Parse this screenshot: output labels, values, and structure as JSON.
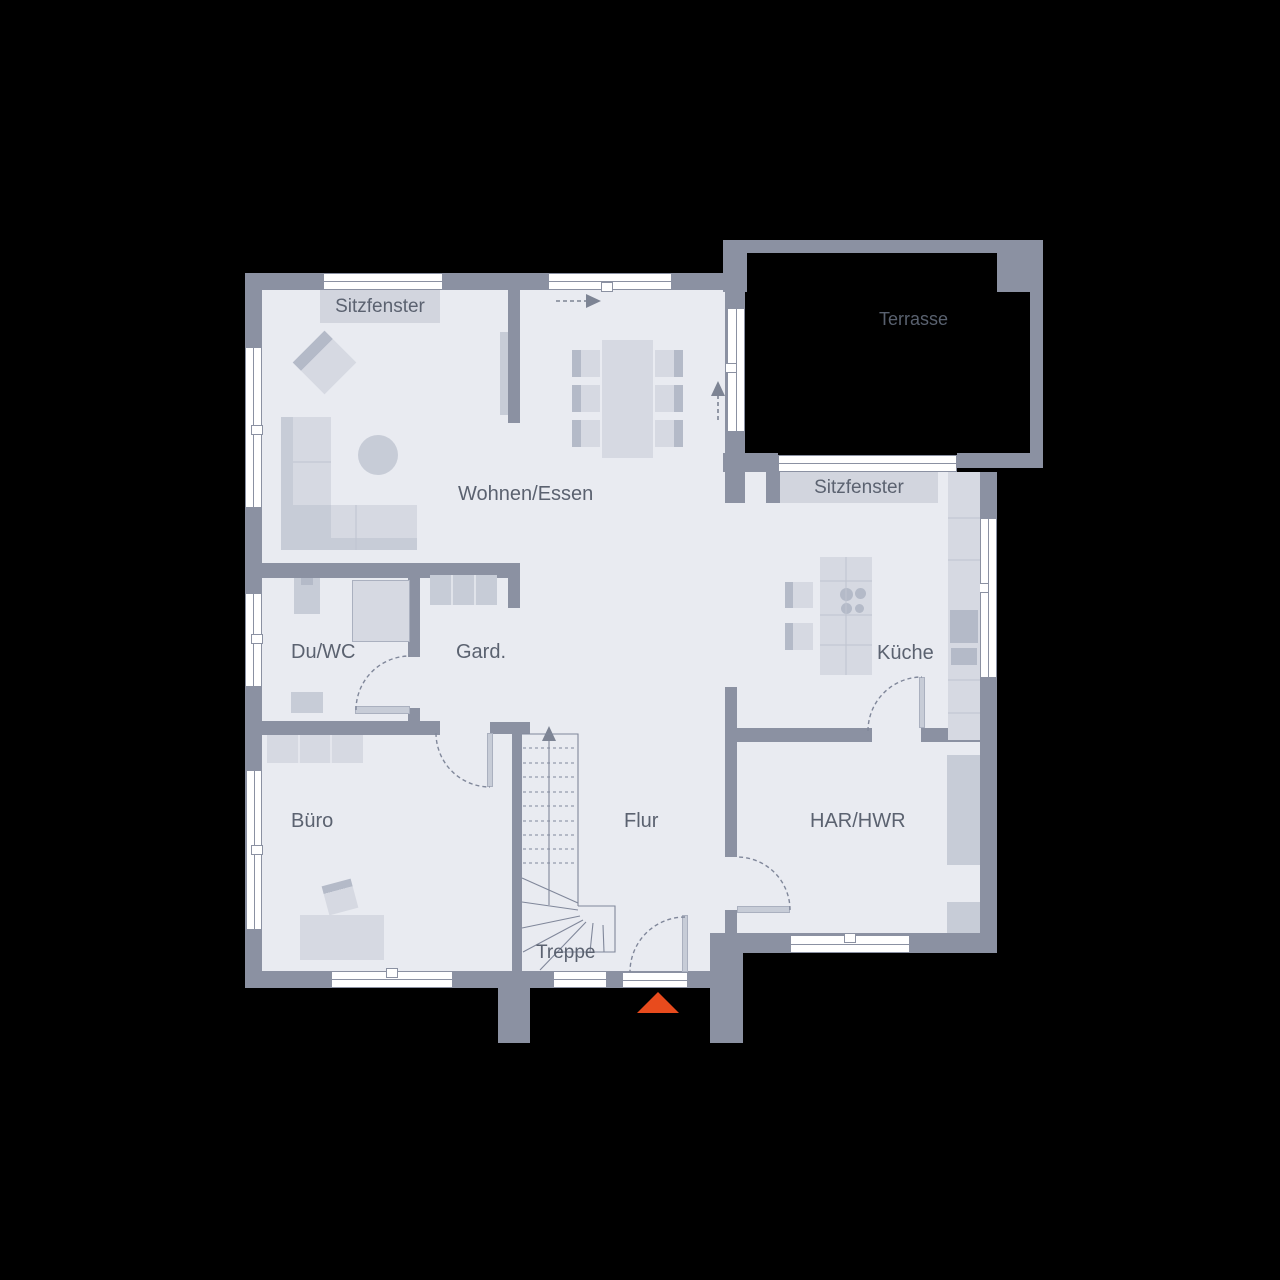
{
  "title": "Erdgeschoss Grundriss",
  "colors": {
    "bg": "#000000",
    "wall": "#8b91a2",
    "floor": "#e9ebf1",
    "furn": "#d6d9e2",
    "furnmid": "#c7ccd7",
    "furndark": "#b4bac8",
    "window": "#ffffff",
    "frame": "#8b91a2",
    "line": "#80879a",
    "arrow": "#7d8494",
    "seatline": "#bfc4d0",
    "gapline": "#e9ebf1",
    "box": "#d2d5de",
    "text": "#5b6270",
    "terrtext": "#59616f",
    "accent": "#e84b1d",
    "showerline": "#aab0bf"
  },
  "rooms": {
    "living": "Wohnen/Essen",
    "terrace": "Terrasse",
    "bay_window_1": "Sitzfenster",
    "bay_window_2": "Sitzfenster",
    "shower_wc": "Du/WC",
    "wardrobe": "Gard.",
    "kitchen": "Küche",
    "office": "Büro",
    "hall": "Flur",
    "utility": "HAR/HWR",
    "stairs": "Treppe"
  },
  "floors": [
    {
      "n": "floor-main",
      "r": [
        262,
        290,
        481,
        681
      ]
    },
    {
      "n": "floor-east",
      "r": [
        727,
        472,
        253,
        461
      ]
    }
  ],
  "walls": [
    {
      "n": "wall-ext-left",
      "r": [
        245,
        273,
        17,
        715
      ]
    },
    {
      "n": "wall-ext-top",
      "r": [
        245,
        273,
        480,
        17
      ]
    },
    {
      "n": "wall-ext-bottom",
      "r": [
        245,
        971,
        498,
        17
      ]
    },
    {
      "n": "wall-ext-right",
      "r": [
        980,
        472,
        17,
        481
      ]
    },
    {
      "n": "wall-utility-bottom",
      "r": [
        710,
        933,
        287,
        20
      ]
    },
    {
      "n": "wall-stub-left",
      "r": [
        498,
        988,
        32,
        55
      ]
    },
    {
      "n": "wall-stub-right",
      "r": [
        710,
        953,
        33,
        90
      ]
    },
    {
      "n": "wall-east-upper",
      "r": [
        725,
        285,
        20,
        218
      ]
    },
    {
      "n": "wall-terrace-top",
      "r": [
        723,
        240,
        320,
        13
      ]
    },
    {
      "n": "wall-terrace-right",
      "r": [
        1030,
        240,
        13,
        228
      ]
    },
    {
      "n": "wall-terrace-pillar-east",
      "r": [
        997,
        240,
        36,
        52
      ]
    },
    {
      "n": "wall-terrace-pillar-west",
      "r": [
        723,
        240,
        24,
        52
      ]
    },
    {
      "n": "wall-terrace-bottom-west",
      "r": [
        723,
        453,
        55,
        19
      ]
    },
    {
      "n": "wall-terrace-bottom-east",
      "r": [
        957,
        453,
        86,
        15
      ]
    },
    {
      "n": "wall-kitchen-stub",
      "r": [
        766,
        472,
        14,
        31
      ]
    },
    {
      "n": "wall-partition-dining",
      "r": [
        508,
        290,
        12,
        133
      ]
    },
    {
      "n": "wall-duwc-top",
      "r": [
        262,
        563,
        258,
        15
      ]
    },
    {
      "n": "wall-duwc-gard-divider",
      "r": [
        408,
        578,
        12,
        79
      ]
    },
    {
      "n": "wall-gard-stub",
      "r": [
        508,
        578,
        12,
        30
      ]
    },
    {
      "n": "wall-office-top",
      "r": [
        262,
        721,
        178,
        14
      ]
    },
    {
      "n": "wall-duwc-pier",
      "r": [
        408,
        708,
        12,
        16
      ]
    },
    {
      "n": "wall-stair-top",
      "r": [
        490,
        722,
        40,
        12
      ]
    },
    {
      "n": "wall-stair-west",
      "r": [
        512,
        722,
        10,
        250
      ]
    },
    {
      "n": "wall-hall-utility-upper",
      "r": [
        725,
        687,
        12,
        170
      ]
    },
    {
      "n": "wall-hall-utility-lower",
      "r": [
        725,
        910,
        12,
        61
      ]
    },
    {
      "n": "wall-kitchen-south-west",
      "r": [
        725,
        728,
        147,
        14
      ]
    },
    {
      "n": "wall-kitchen-south-east",
      "r": [
        921,
        728,
        59,
        14
      ]
    }
  ],
  "windows": [
    {
      "n": "window-bay-north",
      "r": [
        323,
        273,
        120,
        17
      ],
      "o": "h"
    },
    {
      "n": "window-dining-north",
      "r": [
        548,
        273,
        124,
        17
      ],
      "o": "h",
      "hx": 607,
      "hy": 287
    },
    {
      "n": "window-living-west",
      "r": [
        245,
        347,
        17,
        161
      ],
      "o": "v",
      "hx": 257,
      "hy": 430
    },
    {
      "n": "window-duwc-west",
      "r": [
        245,
        593,
        17,
        94
      ],
      "o": "v",
      "hx": 257,
      "hy": 639
    },
    {
      "n": "window-office-west",
      "r": [
        246,
        770,
        16,
        160
      ],
      "o": "v",
      "hx": 257,
      "hy": 850
    },
    {
      "n": "window-office-south",
      "r": [
        331,
        971,
        122,
        17
      ],
      "o": "h",
      "hx": 392,
      "hy": 973
    },
    {
      "n": "window-stair-south",
      "r": [
        553,
        971,
        54,
        17
      ],
      "o": "h"
    },
    {
      "n": "window-kitchen-east",
      "r": [
        980,
        518,
        17,
        160
      ],
      "o": "v",
      "hx": 983,
      "hy": 588
    },
    {
      "n": "window-utility-south",
      "r": [
        790,
        935,
        120,
        18
      ],
      "o": "h",
      "hx": 850,
      "hy": 938
    },
    {
      "n": "window-bay-terrace",
      "r": [
        778,
        455,
        179,
        17
      ],
      "o": "h"
    },
    {
      "n": "door-terrace-glass",
      "r": [
        727,
        308,
        18,
        124
      ],
      "o": "v",
      "hx": 731,
      "hy": 368
    },
    {
      "n": "door-entrance-threshold",
      "r": [
        622,
        972,
        66,
        16
      ],
      "o": "h"
    }
  ],
  "furniture": [
    {
      "n": "sofa-seat-vertical",
      "r": [
        281,
        417,
        50,
        133
      ],
      "c": "furn"
    },
    {
      "n": "sofa-seat-horizontal",
      "r": [
        281,
        505,
        136,
        45
      ],
      "c": "furn"
    },
    {
      "n": "sofa-corner",
      "r": [
        281,
        505,
        50,
        45
      ],
      "c": "furnmid"
    },
    {
      "n": "sofa-back-left",
      "r": [
        281,
        417,
        12,
        133
      ],
      "c": "furnmid"
    },
    {
      "n": "sofa-back-bottom",
      "r": [
        293,
        538,
        124,
        12
      ],
      "c": "furnmid"
    },
    {
      "n": "coffee-table-round",
      "r": [
        358,
        435,
        40,
        40
      ],
      "c": "furnmid",
      "round": true
    },
    {
      "n": "armchair",
      "r": [
        302,
        340,
        45,
        45
      ],
      "rot": 45,
      "grad": "90deg"
    },
    {
      "n": "dining-table",
      "r": [
        602,
        340,
        51,
        118
      ],
      "c": "furn"
    },
    {
      "n": "dining-chair-back",
      "r": [
        572,
        350,
        9,
        27
      ],
      "c": "furndark"
    },
    {
      "n": "dining-chair-seat",
      "r": [
        581,
        350,
        19,
        27
      ],
      "c": "furn"
    },
    {
      "n": "dining-chair-back",
      "r": [
        572,
        385,
        9,
        27
      ],
      "c": "furndark"
    },
    {
      "n": "dining-chair-seat",
      "r": [
        581,
        385,
        19,
        27
      ],
      "c": "furn"
    },
    {
      "n": "dining-chair-back",
      "r": [
        572,
        420,
        9,
        27
      ],
      "c": "furndark"
    },
    {
      "n": "dining-chair-seat",
      "r": [
        581,
        420,
        19,
        27
      ],
      "c": "furn"
    },
    {
      "n": "dining-chair-seat",
      "r": [
        655,
        350,
        19,
        27
      ],
      "c": "furn"
    },
    {
      "n": "dining-chair-back",
      "r": [
        674,
        350,
        9,
        27
      ],
      "c": "furndark"
    },
    {
      "n": "dining-chair-seat",
      "r": [
        655,
        385,
        19,
        27
      ],
      "c": "furn"
    },
    {
      "n": "dining-chair-back",
      "r": [
        674,
        385,
        9,
        27
      ],
      "c": "furndark"
    },
    {
      "n": "dining-chair-seat",
      "r": [
        655,
        420,
        19,
        27
      ],
      "c": "furn"
    },
    {
      "n": "dining-chair-back",
      "r": [
        674,
        420,
        9,
        27
      ],
      "c": "furndark"
    },
    {
      "n": "sliding-door-panel",
      "r": [
        500,
        332,
        8,
        83
      ],
      "c": "furnmid"
    },
    {
      "n": "sink",
      "r": [
        294,
        578,
        26,
        36
      ],
      "c": "furnmid"
    },
    {
      "n": "sink-faucet",
      "r": [
        301,
        578,
        12,
        7
      ],
      "c": "furndark"
    },
    {
      "n": "shower",
      "r": [
        352,
        580,
        58,
        62
      ],
      "c": "furn",
      "bd": true
    },
    {
      "n": "toilet",
      "r": [
        291,
        692,
        32,
        21
      ],
      "c": "furnmid"
    },
    {
      "n": "wardrobe-cabinet",
      "r": [
        430,
        575,
        67,
        30
      ],
      "c": "furnmid"
    },
    {
      "n": "office-shelf",
      "r": [
        267,
        735,
        96,
        28
      ],
      "c": "furn"
    },
    {
      "n": "office-desk",
      "r": [
        300,
        915,
        84,
        45
      ],
      "c": "furn"
    },
    {
      "n": "office-chair",
      "r": [
        325,
        882,
        30,
        30
      ],
      "rot": -15,
      "grad": "180deg"
    },
    {
      "n": "kitchen-island",
      "r": [
        820,
        557,
        52,
        118
      ],
      "c": "furn"
    },
    {
      "n": "cooktop-burner",
      "r": [
        840,
        588,
        13,
        13
      ],
      "c": "furndark",
      "round": true
    },
    {
      "n": "cooktop-burner",
      "r": [
        855,
        588,
        11,
        11
      ],
      "c": "furndark",
      "round": true
    },
    {
      "n": "cooktop-burner",
      "r": [
        841,
        603,
        11,
        11
      ],
      "c": "furndark",
      "round": true
    },
    {
      "n": "cooktop-burner",
      "r": [
        855,
        604,
        9,
        9
      ],
      "c": "furndark",
      "round": true
    },
    {
      "n": "stool-back",
      "r": [
        785,
        582,
        8,
        26
      ],
      "c": "furndark"
    },
    {
      "n": "stool-seat",
      "r": [
        793,
        582,
        20,
        26
      ],
      "c": "furn"
    },
    {
      "n": "stool-back",
      "r": [
        785,
        623,
        8,
        27
      ],
      "c": "furndark"
    },
    {
      "n": "stool-seat",
      "r": [
        793,
        623,
        20,
        27
      ],
      "c": "furn"
    },
    {
      "n": "kitchen-counter-east",
      "r": [
        948,
        472,
        32,
        268
      ],
      "c": "furn"
    },
    {
      "n": "oven",
      "r": [
        950,
        610,
        28,
        33
      ],
      "c": "furndark"
    },
    {
      "n": "kitchen-drawer",
      "r": [
        951,
        648,
        26,
        17
      ],
      "c": "furndark"
    },
    {
      "n": "utility-cabinet",
      "r": [
        947,
        755,
        33,
        110
      ],
      "c": "furnmid"
    },
    {
      "n": "utility-cabinet",
      "r": [
        947,
        902,
        33,
        31
      ],
      "c": "furnmid"
    },
    {
      "n": "door-leaf-duwc",
      "r": [
        355,
        706,
        55,
        8
      ],
      "c": "furnmid",
      "bd": true
    },
    {
      "n": "door-leaf-gard",
      "r": [
        487,
        733,
        6,
        54
      ],
      "c": "furnmid",
      "bd": true
    },
    {
      "n": "door-leaf-kitchen",
      "r": [
        919,
        677,
        6,
        51
      ],
      "c": "furnmid",
      "bd": true
    },
    {
      "n": "door-leaf-utility",
      "r": [
        737,
        906,
        53,
        7
      ],
      "c": "furnmid",
      "bd": true
    },
    {
      "n": "door-leaf-entrance",
      "r": [
        682,
        915,
        6,
        57
      ],
      "c": "furnmid",
      "bd": true
    }
  ],
  "label_boxes": [
    {
      "n": "bay-window-label-box-north",
      "r": [
        320,
        290,
        120,
        33
      ]
    },
    {
      "n": "bay-window-label-box-terrace",
      "r": [
        780,
        472,
        158,
        31
      ]
    }
  ],
  "svg": {
    "door_arcs": [
      {
        "n": "door-arc-duwc",
        "d": "M356 710 A54 54 0 0 1 410 656"
      },
      {
        "n": "door-arc-gard",
        "d": "M436 733 A54 54 0 0 0 490 787"
      },
      {
        "n": "door-arc-kitchen",
        "d": "M868 731 A54 54 0 0 1 922 677"
      },
      {
        "n": "door-arc-utility",
        "d": "M790 910 A53 53 0 0 0 737 857"
      },
      {
        "n": "door-arc-entrance",
        "d": "M685 917 A55 55 0 0 0 630 972"
      }
    ],
    "dashed_arrows": [
      {
        "n": "arrow-line-top",
        "d": "M556 301 H586"
      },
      {
        "n": "arrow-line-terrace",
        "d": "M718 420 V396"
      }
    ],
    "arrow_heads": [
      {
        "n": "arrow-head-top",
        "d": "M586 294 L601 301 L586 308 Z"
      },
      {
        "n": "arrow-head-terrace",
        "d": "M711 396 L725 396 L718 381 Z"
      },
      {
        "n": "arrow-head-stair",
        "d": "M542 741 L556 741 L549 726 Z"
      }
    ],
    "stair_solid": [
      {
        "n": "stair-rail",
        "d": "M549 905 V741"
      },
      {
        "n": "stair-outline",
        "d": "M522 734 H578 V906"
      },
      {
        "n": "stair-winder",
        "d": "M522 878 L578 903"
      },
      {
        "n": "stair-winder",
        "d": "M522 902 L578 910"
      },
      {
        "n": "stair-winder",
        "d": "M522 928 L580 916"
      },
      {
        "n": "stair-winder",
        "d": "M523 952 L583 920"
      },
      {
        "n": "stair-winder",
        "d": "M540 970 L586 922"
      },
      {
        "n": "stair-landing",
        "d": "M578 906 H615 V952 H560"
      },
      {
        "n": "stair-landing-line",
        "d": "M593 923 L590 952"
      },
      {
        "n": "stair-landing-line",
        "d": "M603 925 L604 952"
      }
    ],
    "stair_treads": [
      {
        "d": "M523 748 H577"
      },
      {
        "d": "M523 763 H577"
      },
      {
        "d": "M523 777 H577"
      },
      {
        "d": "M523 792 H577"
      },
      {
        "d": "M523 806 H577"
      },
      {
        "d": "M523 821 H577"
      },
      {
        "d": "M523 835 H577"
      },
      {
        "d": "M523 849 H577"
      },
      {
        "d": "M523 863 H577"
      }
    ],
    "seat_lines": [
      {
        "d": "M293 462 H331"
      },
      {
        "d": "M356 505 V550"
      },
      {
        "d": "M846 557 V675"
      },
      {
        "d": "M820 581 H872"
      },
      {
        "d": "M820 615 H872"
      },
      {
        "d": "M820 645 H872"
      },
      {
        "d": "M948 518 H980"
      },
      {
        "d": "M948 560 H980"
      },
      {
        "d": "M948 680 H980"
      },
      {
        "d": "M948 713 H980"
      }
    ],
    "gap_lines": [
      {
        "d": "M452 575 V605"
      },
      {
        "d": "M475 575 V605"
      },
      {
        "d": "M299 735 V763"
      },
      {
        "d": "M331 735 V763"
      }
    ]
  },
  "labels": [
    {
      "n": "label-bay-window-north",
      "key": "bay_window_1",
      "x": 320,
      "y": 296,
      "s": 19,
      "w": 120,
      "center": true
    },
    {
      "n": "label-bay-window-terrace",
      "key": "bay_window_2",
      "x": 780,
      "y": 477,
      "s": 19,
      "w": 158,
      "center": true
    },
    {
      "n": "label-terrace",
      "key": "terrace",
      "x": 879,
      "y": 309,
      "s": 18,
      "c": "terrtext"
    },
    {
      "n": "label-living",
      "key": "living",
      "x": 458,
      "y": 483,
      "s": 20
    },
    {
      "n": "label-shower-wc",
      "key": "shower_wc",
      "x": 291,
      "y": 641,
      "s": 20
    },
    {
      "n": "label-wardrobe",
      "key": "wardrobe",
      "x": 456,
      "y": 641,
      "s": 20
    },
    {
      "n": "label-kitchen",
      "key": "kitchen",
      "x": 877,
      "y": 642,
      "s": 20
    },
    {
      "n": "label-office",
      "key": "office",
      "x": 291,
      "y": 810,
      "s": 20
    },
    {
      "n": "label-hall",
      "key": "hall",
      "x": 624,
      "y": 810,
      "s": 20
    },
    {
      "n": "label-utility",
      "key": "utility",
      "x": 810,
      "y": 810,
      "s": 20
    },
    {
      "n": "label-stairs",
      "key": "stairs",
      "x": 536,
      "y": 942,
      "s": 19
    }
  ],
  "entrance_marker": {
    "n": "entrance-marker",
    "x": 637,
    "y": 992,
    "half_w": 21,
    "h": 21
  }
}
